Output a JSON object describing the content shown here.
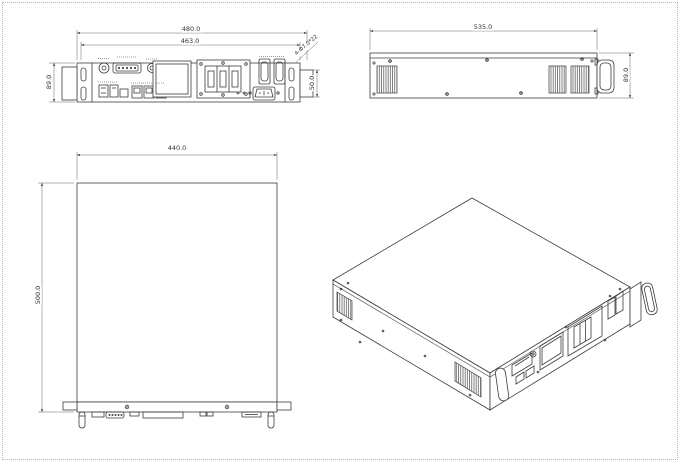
{
  "dimensions": {
    "front": {
      "total_width": "480.0",
      "body_width": "463.0",
      "height": "89.0",
      "handle_height": "50.0",
      "slot_note": "4-Φ7.0*22"
    },
    "side": {
      "length": "535.0",
      "height": "89.0"
    },
    "top": {
      "width": "440.0",
      "depth": "500.0"
    }
  }
}
